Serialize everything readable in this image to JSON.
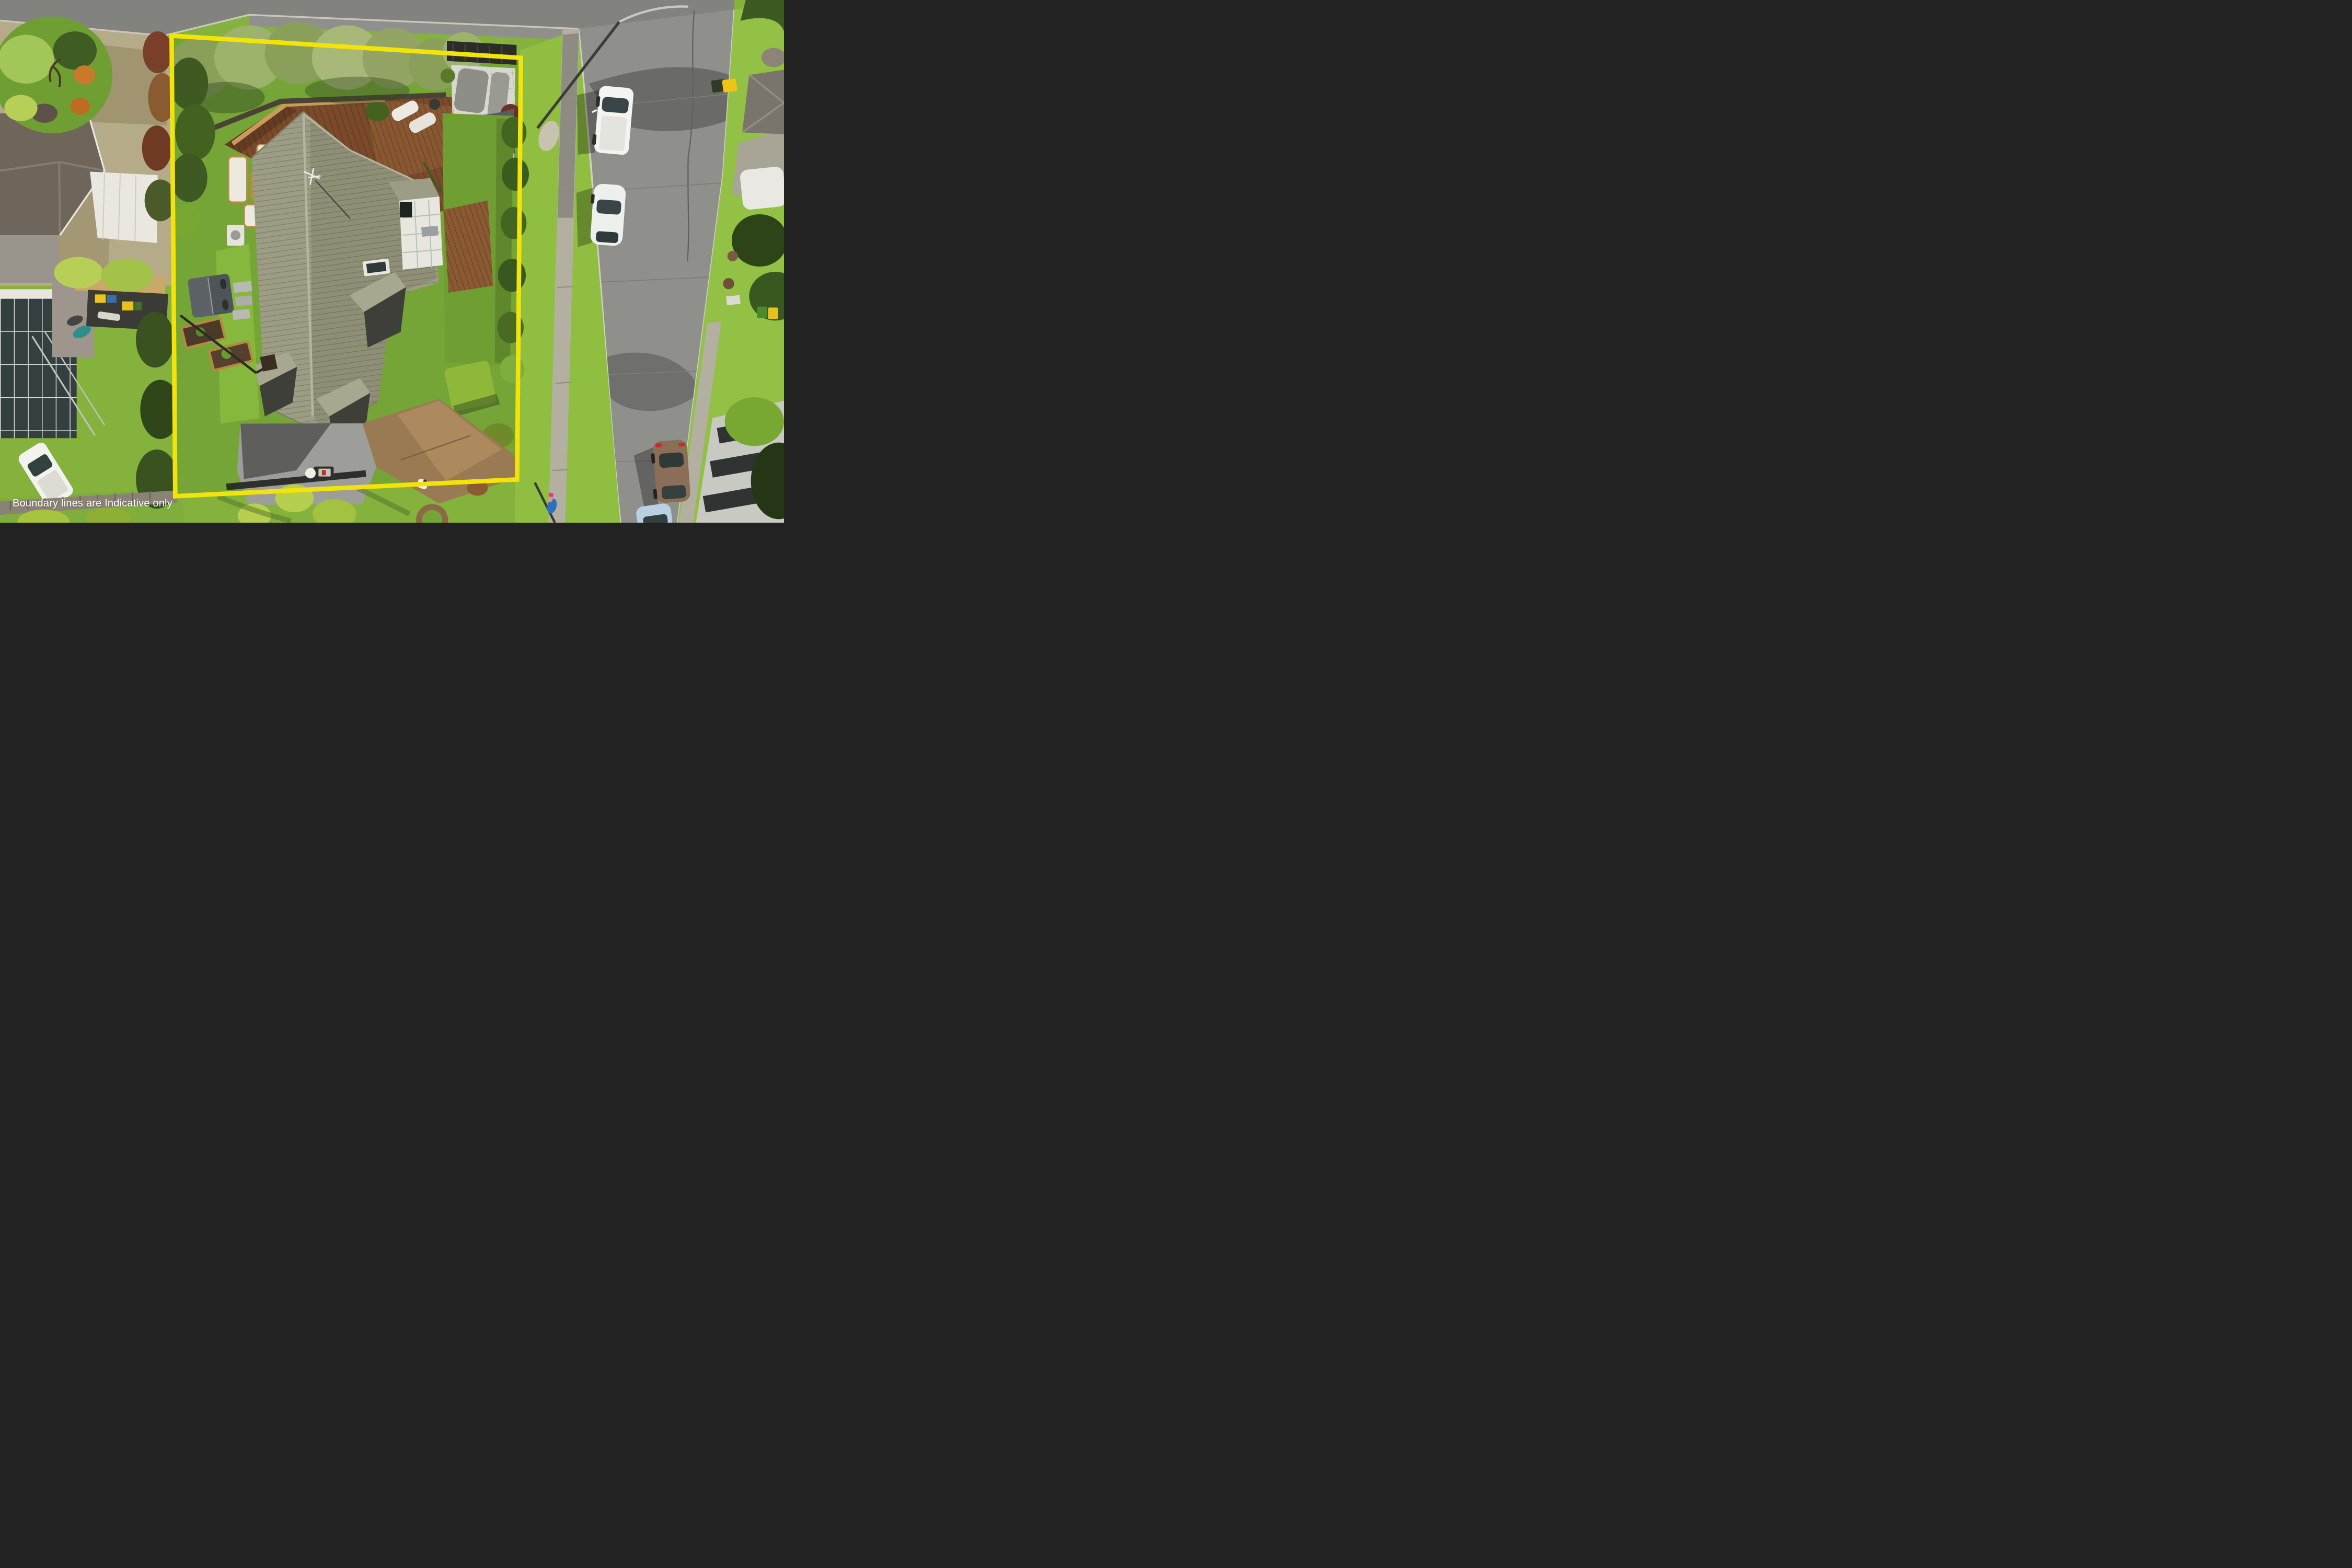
{
  "overlay": {
    "disclaimer_text": "Boundary lines are Indicative only",
    "disclaimer_color": "#ffffff",
    "boundary_color": "#f2e30a",
    "boundary_corners": [
      [
        985,
        205
      ],
      [
        2990,
        332
      ],
      [
        2968,
        2752
      ],
      [
        1006,
        2848
      ]
    ]
  },
  "palette": {
    "road_asphalt": "#8f908c",
    "kerb": "#d2d0c6",
    "footpath_concrete": "#b3b0a2",
    "berm_grass": "#8fbe41",
    "property_lawn": "#75a437",
    "driveway_tan": "#b6ab88",
    "inner_driveway_brown": "#9a7a52",
    "deck_wood": "#7b4a2a",
    "house_roof_olive": "#9d9c84",
    "neighbor_roof_shingle": "#6e655b",
    "hedge_dark": "#3e5a22",
    "olive_tree": "#93a464",
    "shade_sail_gray": "#5b5d5b",
    "pergola_wood": "#b5692c",
    "paver_white": "#d9d8cf",
    "hot_tub_gray": "#4e5458",
    "gravel": "#9d9d99",
    "car_white": "#f4f4f1",
    "car_brown": "#8a6e58",
    "car_blue": "#b9cfe2",
    "bin_yellow": "#f0c416",
    "bin_green": "#4a8a28",
    "bin_blue": "#3a6ea8"
  },
  "scene_inventory": {
    "type": "aerial-property-photograph",
    "vehicles": [
      {
        "name": "white-van-parked-road",
        "color": "#f4f4f1"
      },
      {
        "name": "white-hatchback-parked-road",
        "color": "#f4f4f1"
      },
      {
        "name": "brown-sedan-parked-road",
        "color": "#8a6e58"
      },
      {
        "name": "blue-car-parked-road",
        "color": "#b9cfe2"
      },
      {
        "name": "white-ute-neighbor-driveway",
        "color": "#f2f2ef"
      }
    ],
    "property_features": [
      "main-house-olive-metal-roof",
      "timber-deck",
      "outdoor-lounge-set",
      "sun-loungers",
      "shade-sail-patio",
      "pergola",
      "white-paver-courtyard",
      "roof-courtyard",
      "skylight",
      "tv-antenna",
      "hot-tub",
      "raised-garden-beds",
      "stepping-stones",
      "gravel-parking-pad",
      "brown-concrete-driveway",
      "letterbox",
      "olive-tree-row",
      "boundary-hedges",
      "trimmed-hedge",
      "flax-plants"
    ],
    "street_features": [
      "asphalt-road",
      "concrete-footpath",
      "grass-berm",
      "street-light",
      "road-crack-seal",
      "recycling-bin-at-kerb",
      "pedestrian-on-footpath",
      "palm-tree-shadows"
    ],
    "neighbor_features": [
      "shingle-hip-roof-house",
      "white-awning",
      "modern-glass-house",
      "carport-with-bins",
      "garden-island",
      "timber-walkway",
      "white-caravan",
      "apartment-building",
      "driveway-crossing",
      "manhole-covers"
    ]
  }
}
